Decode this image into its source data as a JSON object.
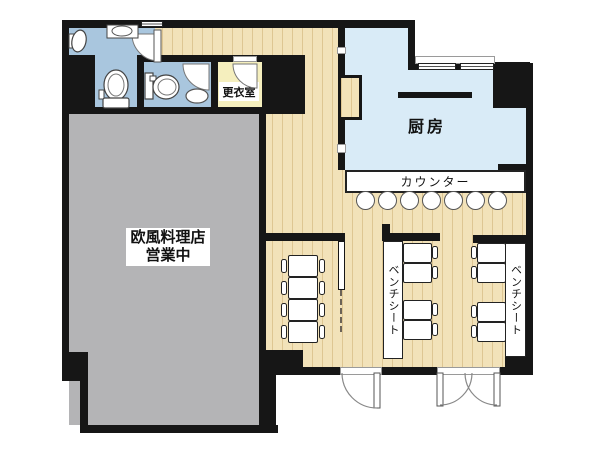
{
  "floorplan": {
    "labels": {
      "changing_room": "更衣室",
      "kitchen": "厨房",
      "counter": "カウンター",
      "restaurant_line1": "欧風料理店",
      "restaurant_line2": "営業中",
      "bench_seat_center": "ベンチシート",
      "bench_seat_right": "ベンチシート"
    },
    "colors": {
      "wall": "#161616",
      "wood_floor": "#f2e2b9",
      "kitchen_floor": "#d9ebf7",
      "toilet_floor": "#a9c6de",
      "changing_floor": "#f5efbe",
      "vacant_room": "#b4b4b6",
      "fixture": "#ffffff"
    },
    "counts": {
      "counter_stools": 7,
      "tables_left_nook": 4,
      "tables_center_column": 4,
      "tables_right_column": 4,
      "toilets": 2,
      "urinals": 1,
      "sinks": 2,
      "entrance_doors": 2
    }
  }
}
